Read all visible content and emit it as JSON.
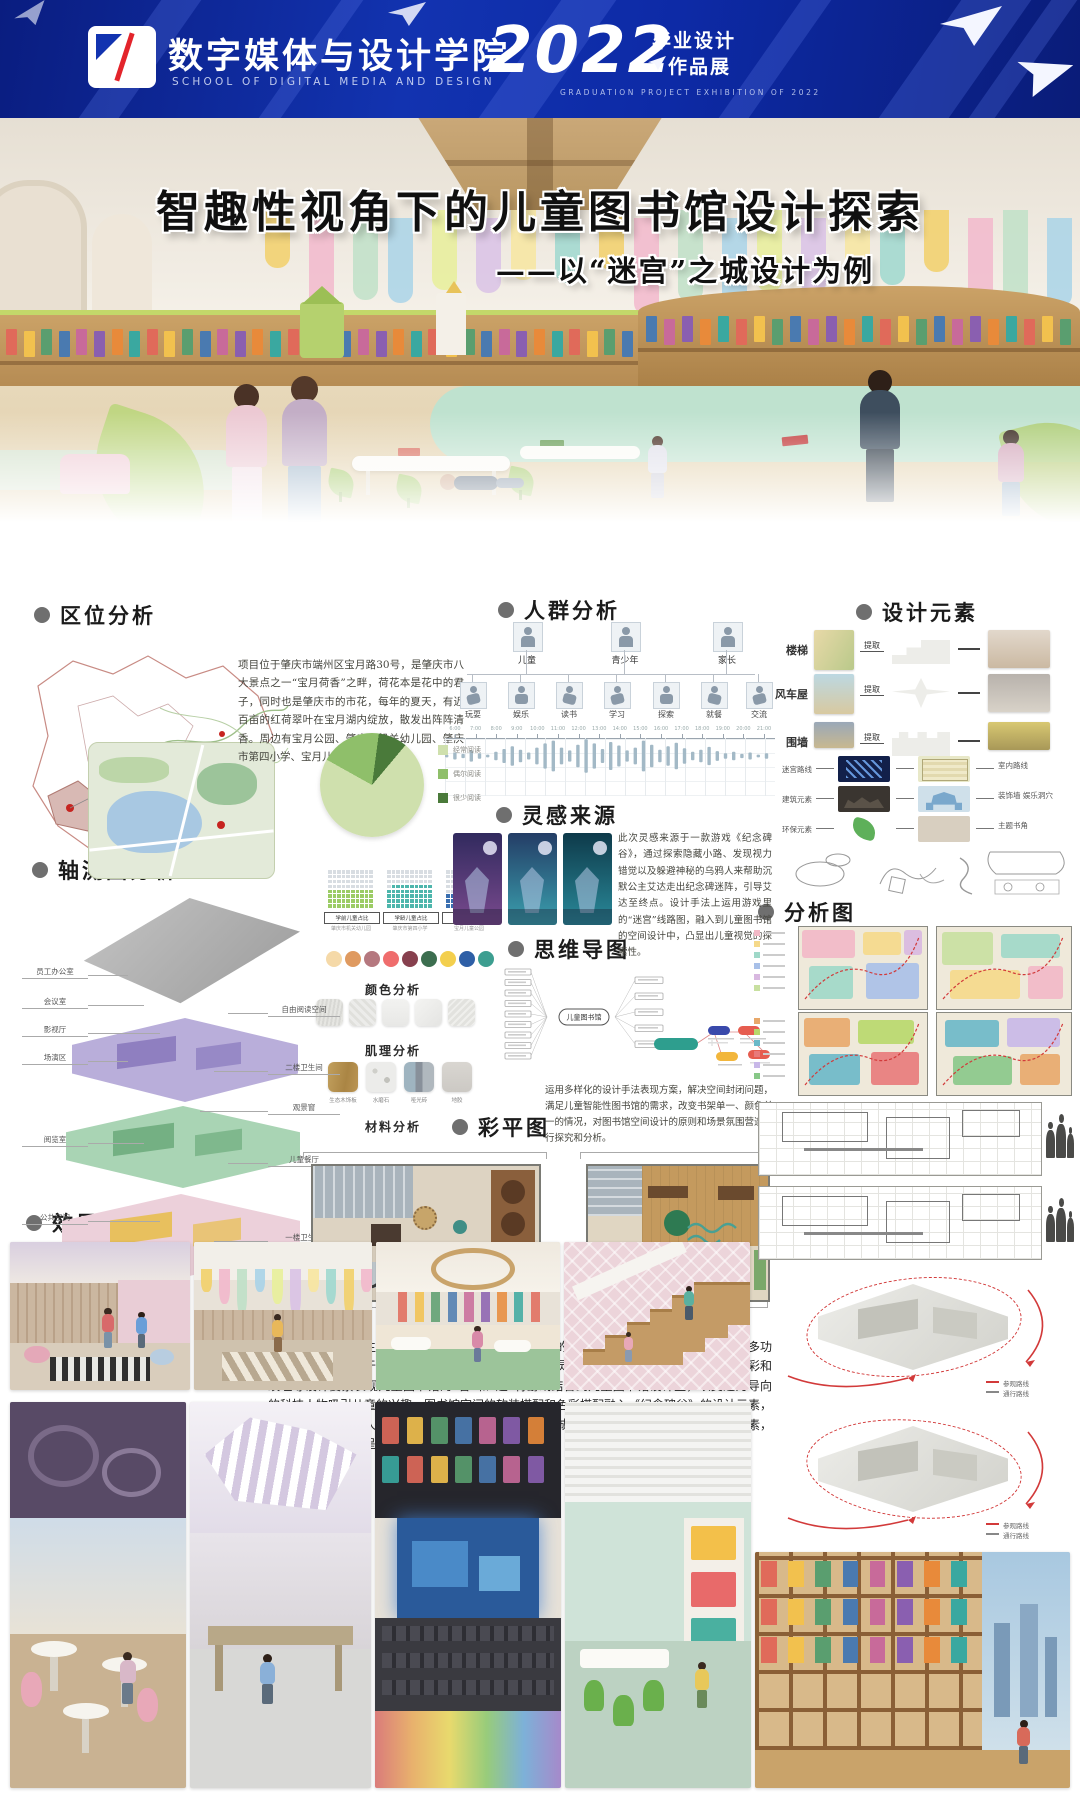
{
  "banner": {
    "school_cn": "数字媒体与设计学院",
    "school_en": "SCHOOL OF DIGITAL MEDIA AND DESIGN",
    "year": "2022",
    "exhibit_line1": "毕业设计",
    "exhibit_line2": "作品展",
    "exhibit_en": "GRADUATION PROJECT EXHIBITION OF 2022",
    "colors": {
      "bg": "#0d2aa6",
      "accent": "#e3242b"
    }
  },
  "title": {
    "main": "智趣性视角下的儿童图书馆设计探索",
    "sub": "——以“迷宫”之城设计为例"
  },
  "hero": {
    "panel_colors": [
      "#f2d06a",
      "#f2b8cc",
      "#bfe0c8",
      "#a9d3e8",
      "#e8ef9a",
      "#d9c2e6",
      "#f7e6a0",
      "#9fd8cf"
    ],
    "book_colors": [
      "#e06a5a",
      "#f2c14e",
      "#5a9e6f",
      "#4a7ab0",
      "#c86a9a",
      "#8a5fb0",
      "#e88a3a",
      "#3aa8a0"
    ]
  },
  "sections": {
    "location": {
      "label": "区位分析",
      "text": "项目位于肇庆市端州区宝月路30号，是肇庆市八大景点之一“宝月荷香”之畔，荷花本是花中的君子，同时也是肇庆市的市花，每年的夏天，有近百亩的红荷翠叶在宝月湖内绽放，散发出阵阵清香。周边有宝月公园、肇庆市机关幼儿园、肇庆市第四小学、宝月儿童公园等。"
    },
    "people": {
      "label": "人群分析",
      "groups": [
        "儿童",
        "青少年",
        "家长"
      ],
      "activities": [
        "玩耍",
        "娱乐",
        "读书",
        "学习",
        "探索",
        "就餐",
        "交流"
      ],
      "timeline_ticks": [
        "6:00",
        "7:00",
        "8:00",
        "9:00",
        "10:00",
        "11:00",
        "12:00",
        "13:00",
        "14:00",
        "15:00",
        "16:00",
        "17:00",
        "18:00",
        "19:00",
        "20:00",
        "21:00"
      ]
    },
    "elements": {
      "label": "设计元素",
      "extract": "提取",
      "items": [
        "楼梯",
        "风车屋",
        "围墙"
      ],
      "mappings": [
        {
          "from": "迷宫路线",
          "to": "室内路线"
        },
        {
          "from": "建筑元素",
          "to": "装饰墙 娱乐洞穴"
        },
        {
          "from": "环保元素",
          "to": "主题书角"
        }
      ]
    },
    "inspiration": {
      "label": "灵感来源",
      "text": "此次灵感来源于一款游戏《纪念碑谷》，通过探索隐藏小路、发现视力错觉以及躲避神秘的乌鸦人来帮助沉默公主艾达走出纪念碑迷阵，引导艾达至终点。设计手法上运用游戏里的“迷宫”线路图，融入到儿童图书馆的空间设计中，凸显出儿童视觉的探索性。"
    },
    "mindmap": {
      "label": "思维导图",
      "center": "儿童图书馆"
    },
    "axon": {
      "label": "轴测图分析",
      "left_labels": [
        "员工办公室",
        "会议室",
        "影视厅",
        "场演区",
        "阅览室",
        "公共空间",
        "阅览室"
      ],
      "right_labels": [
        "自由阅读空间",
        "二楼卫生间",
        "观景窗",
        "儿童餐厅",
        "一楼卫生间",
        "阅览室"
      ]
    },
    "pie": {
      "legend": [
        "经常阅读",
        "偶尔阅读",
        "很少阅读"
      ],
      "values": [
        72,
        19,
        9
      ],
      "colors": [
        "#cfe0ad",
        "#8fbf6a",
        "#4a7a3a"
      ]
    },
    "waffles": {
      "tags": [
        "学前儿童占比",
        "学龄儿童占比",
        "亲子家庭占比"
      ],
      "notes": [
        "肇庆市机关幼儿园",
        "肇庆市第四小学",
        "宝月儿童公园"
      ],
      "colors": [
        "#9ccc65",
        "#4db6ac",
        "#3a6fb0"
      ],
      "fills": [
        0.5,
        0.62,
        0.38
      ]
    },
    "color_analysis": {
      "label": "颜色分析",
      "palette": [
        "#f5d9a8",
        "#df9a60",
        "#b5787f",
        "#ef6d6d",
        "#87404e",
        "#3c6e4f",
        "#f3cf4e",
        "#2e5fa6",
        "#3d9e90"
      ]
    },
    "texture": {
      "label": "肌理分析"
    },
    "material": {
      "label": "材料分析",
      "names": [
        "生态木饰板",
        "水磨石",
        "哑光砖",
        "地胶"
      ]
    },
    "plan": {
      "label": "彩平图",
      "note": "运用多样化的设计手法表现方案，解决空间封闭问题，满足儿童智能性图书馆的需求，改变书架单一、颜色单一的情况，对图书馆空间设计的原则和场景氛围营造进行探究和分析。",
      "captions": [
        "一层平面图",
        "二层平面图"
      ],
      "scale": "1:100"
    },
    "analysis": {
      "label": "分析图",
      "route_legend": [
        "参观路线",
        "通行路线"
      ]
    },
    "renders": {
      "label": "效果图"
    },
    "summary": "本方案是现代主义风格为主，空间特点是色彩跳跃的个性化空间；实用的个性化空间；多功能的个性空间。对于设计儿童图书馆，既有实用性又有灵活性，营造主题元素空间，提取色彩和纹理等设计要素表现儿童图书馆的“智”和“趣”将游戏结合到儿童图书馆设计里，以艾达为导向的科技人物吸引儿童的兴趣，图书馆空间的软装搭配和色彩搭配融入《纪念碑谷》的设计元素，除了艾达还有乌鸦人和图腾，从游戏中提取几何图形、城堡，也加入了当地宋城墙的外形元素，以艺术装置的形式呈现，更能凸显阅读空间的趣味性。"
  }
}
